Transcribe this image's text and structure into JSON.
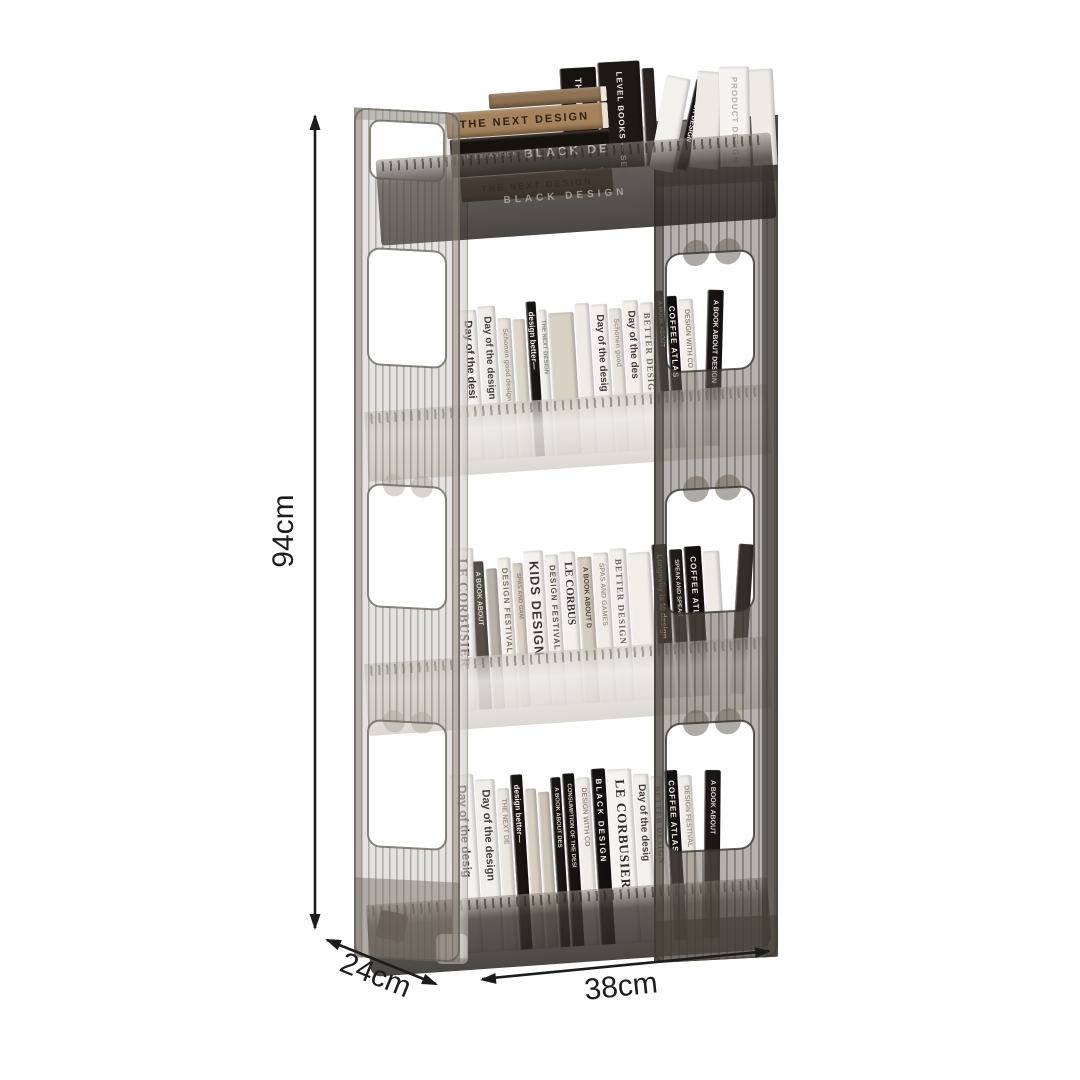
{
  "annotations": {
    "height": "94cm",
    "depth": "24cm",
    "width": "38cm"
  },
  "colors": {
    "background": "#ffffff",
    "dimension_line": "#1c1c1c",
    "frame_smoke": "#6f655b",
    "frame_smoke_light": "#968e84",
    "tray_frost": "#e9e6e1",
    "tray_dark": "#4a443e"
  },
  "shelf": {
    "tray_engraving": "BLACK DESIGN",
    "top_stack": [
      {
        "t": "",
        "bg": "#8f7354",
        "h": 15,
        "w": 118,
        "edge": "#efe8da"
      },
      {
        "t": "THE NEXT DESIGN",
        "bg": "#a5835c",
        "fg": "#2e2315",
        "h": 26,
        "w": 162,
        "edge": "#e8dfcf",
        "size": 11,
        "ls": 2
      },
      {
        "t": "BLACK DESIGN",
        "sub": "OPEN EXPANSION RANGE",
        "bg": "#16120e",
        "fg": "#f2efe8",
        "h": 38,
        "w": 160,
        "size": 12,
        "ls": 3
      },
      {
        "t": "THE NEXT DESIGN",
        "bg": "#6d5339",
        "fg": "#241a10",
        "h": 24,
        "w": 152,
        "size": 9,
        "ls": 2
      }
    ],
    "top_vertical": [
      {
        "t": "THE NEXT DESIGN",
        "bg": "#17130f",
        "fg": "#efece4",
        "w": 36,
        "h": 102,
        "size": 9,
        "ls": 1
      },
      {
        "t": "LEVEL BOOKS — SERIES",
        "bg": "#1d1915",
        "fg": "#f0ede6",
        "w": 42,
        "h": 106,
        "size": 8,
        "ls": 1
      },
      {
        "t": "",
        "bg": "#2a2521",
        "w": 12,
        "h": 98
      }
    ],
    "top_leaning": [
      {
        "t": "",
        "bg": "#f3f1ec",
        "w": 24,
        "h": 95,
        "lean": 14
      },
      {
        "t": "BLACK DESIGN",
        "bg": "#141110",
        "fg": "#f3f0e9",
        "w": 11,
        "h": 92,
        "lean": 16,
        "size": 7
      },
      {
        "t": "",
        "bg": "#edeae4",
        "w": 28,
        "h": 97,
        "lean": 8
      },
      {
        "t": "PRODUCT DESIGN",
        "bg": "#f6f4f0",
        "fg": "#b7b1a7",
        "w": 30,
        "h": 100,
        "lean": 2,
        "size": 8,
        "ls": 1
      },
      {
        "t": "",
        "bg": "#efece6",
        "w": 24,
        "h": 96,
        "lean": 0
      }
    ],
    "tiers": [
      {
        "name": "tier-2",
        "books": [
          {
            "t": "Day of the desi",
            "bg": "#f4f2ee",
            "fg": "#3a362f",
            "w": 18,
            "h": 150,
            "size": 11
          },
          {
            "t": "Day of the design",
            "bg": "#efede8",
            "fg": "#45413a",
            "w": 17,
            "h": 153,
            "size": 10
          },
          {
            "t": "Schonen good design",
            "bg": "#e7e3db",
            "fg": "#9a948a",
            "w": 13,
            "h": 140,
            "size": 7
          },
          {
            "t": "",
            "bg": "#ddd6ca",
            "w": 12,
            "h": 138
          },
          {
            "t": "design better—",
            "bg": "#1a1714",
            "fg": "#f1eee7",
            "w": 10,
            "h": 155,
            "size": 8
          },
          {
            "t": "THE NEXT DESIGN",
            "bg": "#f1efe9",
            "fg": "#8e887d",
            "w": 8,
            "h": 146,
            "size": 6
          },
          {
            "t": "",
            "bg": "#d8d1c4",
            "w": 25,
            "h": 142
          },
          {
            "t": "",
            "bg": "#efece6",
            "w": 14,
            "h": 150
          },
          {
            "t": "Day of the desig",
            "bg": "#f4f1ec",
            "fg": "#3c382f",
            "w": 16,
            "h": 148,
            "size": 10
          },
          {
            "t": "Schonen good",
            "bg": "#e9e5dd",
            "fg": "#a09a8f",
            "w": 12,
            "h": 143,
            "size": 7
          },
          {
            "t": "Day of the des",
            "bg": "#f3f0ea",
            "fg": "#413d35",
            "w": 15,
            "h": 150,
            "size": 10
          },
          {
            "t": "BETTER DESIG",
            "bg": "#f0ede7",
            "fg": "#6e6a60",
            "w": 13,
            "h": 147,
            "serif": true,
            "size": 9,
            "ls": 1
          },
          {
            "t": "A BOOK ABOUT",
            "bg": "#1c1916",
            "fg": "#d9d4c9",
            "w": 9,
            "h": 158,
            "size": 6
          },
          {
            "t": "COFFEE ATLAS",
            "bg": "#13100d",
            "fg": "#f3f0e8",
            "w": 11,
            "h": 152,
            "size": 8,
            "ls": 1
          },
          {
            "t": "DESIGN WITH CO",
            "bg": "#f2efe9",
            "fg": "#8b8579",
            "w": 14,
            "h": 148,
            "size": 7
          },
          {
            "t": "A BOOK ABOUT DESIGN",
            "bg": "#181411",
            "fg": "#e8e3d8",
            "w": 16,
            "h": 156,
            "lean": 5,
            "size": 7
          }
        ]
      },
      {
        "name": "tier-3",
        "books": [
          {
            "t": "LE CORBUSIER",
            "bg": "#f5f3ef",
            "fg": "#2e2a25",
            "w": 22,
            "h": 162,
            "serif": true,
            "size": 13,
            "ls": 1,
            "lean": 2
          },
          {
            "t": "A BOOK ABOUT",
            "bg": "#565049",
            "fg": "#d8d3c9",
            "w": 13,
            "h": 148,
            "size": 7
          },
          {
            "t": "",
            "bg": "#b8b1a5",
            "w": 11,
            "h": 140
          },
          {
            "t": "DESIGN FESTIVAL",
            "bg": "#f2efe9",
            "fg": "#75705f",
            "w": 12,
            "h": 150,
            "size": 8,
            "ls": 1
          },
          {
            "t": "SPAS AND GAM",
            "bg": "#d9d2c5",
            "fg": "#8c8577",
            "w": 10,
            "h": 144,
            "size": 6
          },
          {
            "t": "KIDS DESIGN",
            "bg": "#f5f2ed",
            "fg": "#3b3630",
            "w": 19,
            "h": 155,
            "size": 13,
            "ls": 1
          },
          {
            "t": "DESIGN FESTIVAL",
            "bg": "#f1eee8",
            "fg": "#55504a",
            "w": 13,
            "h": 150,
            "size": 8,
            "ls": 1
          },
          {
            "t": "LE CORBUS",
            "bg": "#f4f1eb",
            "fg": "#3a352e",
            "w": 15,
            "h": 152,
            "serif": true,
            "size": 11
          },
          {
            "t": "A BOOK ABOUT D",
            "bg": "#d4ccbd",
            "fg": "#4e4537",
            "w": 14,
            "h": 146,
            "size": 7
          },
          {
            "t": "SPAS AND GAMES",
            "bg": "#f0ede6",
            "fg": "#9d978b",
            "w": 15,
            "h": 149,
            "size": 7
          },
          {
            "t": "BETTER DESIGN",
            "bg": "#f3f0eb",
            "fg": "#6b665c",
            "w": 16,
            "h": 152,
            "serif": true,
            "size": 9,
            "ls": 1
          },
          {
            "t": "",
            "bg": "#f1eee8",
            "w": 22,
            "h": 147
          },
          {
            "t": "Longevity is to design",
            "bg": "#161310",
            "fg": "#c9b38b",
            "w": 15,
            "h": 154,
            "size": 8
          },
          {
            "t": "SPEAK AND SPEAK",
            "bg": "#211d18",
            "fg": "#d6d0c4",
            "w": 13,
            "h": 148,
            "size": 6
          },
          {
            "t": "COFFEE ATL",
            "bg": "#14110e",
            "fg": "#efebe2",
            "w": 17,
            "h": 150,
            "size": 8,
            "ls": 1
          },
          {
            "t": "",
            "bg": "#eeebe5",
            "w": 16,
            "h": 144
          },
          {
            "t": "",
            "bg": "#332e29",
            "w": 15,
            "h": 150,
            "lean": 7
          }
        ]
      },
      {
        "name": "tier-4",
        "books": [
          {
            "t": "Day of the desig",
            "bg": "#f5f3ef",
            "fg": "#38342d",
            "w": 23,
            "h": 178,
            "size": 12
          },
          {
            "t": "Day of the design",
            "bg": "#f1efe9",
            "fg": "#44403a",
            "w": 19,
            "h": 172,
            "size": 11
          },
          {
            "t": "THE NEXT DE",
            "bg": "#ece8e0",
            "fg": "#9b958a",
            "w": 12,
            "h": 162,
            "size": 7
          },
          {
            "t": "design better—",
            "bg": "#191511",
            "fg": "#efece5",
            "w": 12,
            "h": 175,
            "size": 8
          },
          {
            "t": "",
            "bg": "#d6cfc2",
            "w": 11,
            "h": 160
          },
          {
            "t": "",
            "bg": "#cdc5b6",
            "w": 11,
            "h": 156
          },
          {
            "t": "A BOOK ABOUT DES",
            "bg": "#1a1613",
            "fg": "#ddd8cd",
            "w": 10,
            "h": 170,
            "size": 6
          },
          {
            "t": "CONSUMPTION OF THE DESI",
            "bg": "#15120f",
            "fg": "#d9d4c9",
            "w": 12,
            "h": 173,
            "size": 6
          },
          {
            "t": "DESIGN WITH CO",
            "bg": "#f1eee8",
            "fg": "#8d877b",
            "w": 13,
            "h": 168,
            "size": 7
          },
          {
            "t": "BLACK DESIGN",
            "bg": "#121010",
            "fg": "#f1eee6",
            "w": 14,
            "h": 176,
            "size": 8,
            "ls": 2
          },
          {
            "t": "LE CORBUSIER",
            "bg": "#f6f4f0",
            "fg": "#2c2823",
            "w": 24,
            "h": 174,
            "serif": true,
            "size": 13,
            "ls": 1
          },
          {
            "t": "Day of the desig",
            "bg": "#f2f0ea",
            "fg": "#413d36",
            "w": 15,
            "h": 168,
            "size": 10
          },
          {
            "t": "BETTER DESIGN",
            "bg": "#f3f1ec",
            "fg": "#6f6a60",
            "w": 12,
            "h": 165,
            "serif": true,
            "size": 8,
            "ls": 1
          },
          {
            "t": "COFFEE ATLAS",
            "bg": "#131010",
            "fg": "#f2efe7",
            "w": 13,
            "h": 170,
            "size": 8,
            "ls": 1
          },
          {
            "t": "DESIGN FESTIVAL",
            "bg": "#f0ede7",
            "fg": "#97918a",
            "w": 12,
            "h": 164,
            "size": 7
          },
          {
            "t": "A BOOK ABOUT",
            "bg": "#1b1714",
            "fg": "#d8d2c6",
            "w": 16,
            "h": 168,
            "lean": 4,
            "size": 7
          }
        ]
      }
    ]
  }
}
